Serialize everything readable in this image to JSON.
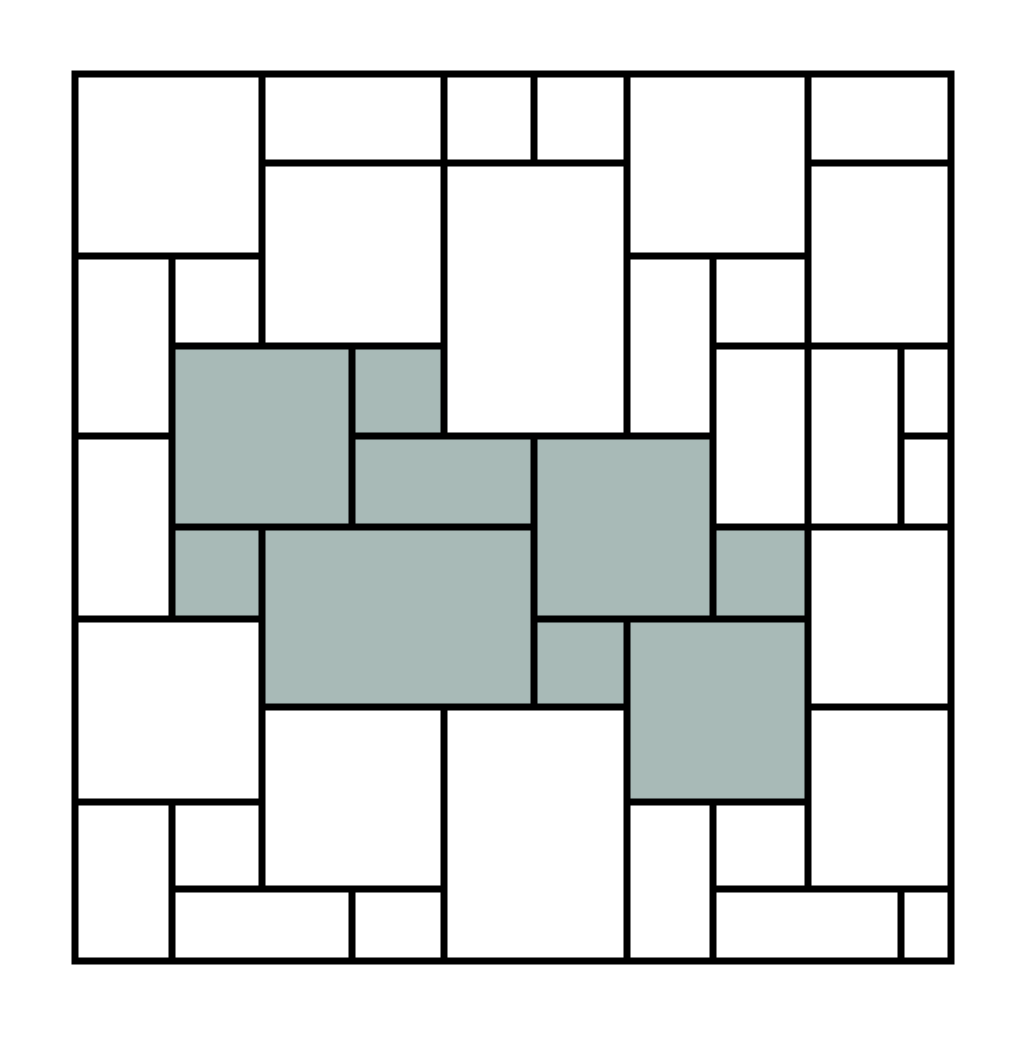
{
  "figure": {
    "canvas_width": 1024,
    "canvas_height": 1038,
    "background_color": "#ffffff",
    "stroke_color": "#000000",
    "stroke_width": 7,
    "tile_fill_white": "#ffffff",
    "tile_fill_shaded": "#a8bab7",
    "outer_square": {
      "x": 75,
      "y": 74,
      "width": 876,
      "height": 887
    },
    "grid_x": [
      75,
      172,
      262,
      352,
      444,
      534,
      627,
      713,
      808,
      901,
      951
    ],
    "grid_y": [
      74,
      163,
      256,
      346,
      436,
      527,
      619,
      707,
      802,
      889,
      961
    ],
    "tiles": [
      {
        "c1": 0,
        "r1": 0,
        "c2": 2,
        "r2": 2,
        "shaded": false
      },
      {
        "c1": 2,
        "r1": 0,
        "c2": 4,
        "r2": 1,
        "shaded": false
      },
      {
        "c1": 4,
        "r1": 0,
        "c2": 5,
        "r2": 1,
        "shaded": false
      },
      {
        "c1": 5,
        "r1": 0,
        "c2": 6,
        "r2": 1,
        "shaded": false
      },
      {
        "c1": 6,
        "r1": 0,
        "c2": 8,
        "r2": 2,
        "shaded": false
      },
      {
        "c1": 8,
        "r1": 0,
        "c2": 10,
        "r2": 1,
        "shaded": false
      },
      {
        "c1": 2,
        "r1": 1,
        "c2": 4,
        "r2": 3,
        "shaded": false
      },
      {
        "c1": 4,
        "r1": 1,
        "c2": 6,
        "r2": 4,
        "shaded": false
      },
      {
        "c1": 8,
        "r1": 1,
        "c2": 10,
        "r2": 3,
        "shaded": false
      },
      {
        "c1": 0,
        "r1": 2,
        "c2": 1,
        "r2": 4,
        "shaded": false
      },
      {
        "c1": 1,
        "r1": 2,
        "c2": 2,
        "r2": 3,
        "shaded": false
      },
      {
        "c1": 6,
        "r1": 2,
        "c2": 7,
        "r2": 4,
        "shaded": false
      },
      {
        "c1": 7,
        "r1": 2,
        "c2": 8,
        "r2": 3,
        "shaded": false
      },
      {
        "c1": 7,
        "r1": 3,
        "c2": 8,
        "r2": 5,
        "shaded": false
      },
      {
        "c1": 8,
        "r1": 3,
        "c2": 9,
        "r2": 5,
        "shaded": false
      },
      {
        "c1": 9,
        "r1": 3,
        "c2": 10,
        "r2": 4,
        "shaded": false
      },
      {
        "c1": 9,
        "r1": 4,
        "c2": 10,
        "r2": 5,
        "shaded": false
      },
      {
        "c1": 0,
        "r1": 4,
        "c2": 1,
        "r2": 6,
        "shaded": false
      },
      {
        "c1": 1,
        "r1": 3,
        "c2": 3,
        "r2": 5,
        "shaded": true
      },
      {
        "c1": 3,
        "r1": 3,
        "c2": 4,
        "r2": 4,
        "shaded": true
      },
      {
        "c1": 3,
        "r1": 4,
        "c2": 5,
        "r2": 5,
        "shaded": true
      },
      {
        "c1": 5,
        "r1": 4,
        "c2": 7,
        "r2": 6,
        "shaded": true
      },
      {
        "c1": 1,
        "r1": 5,
        "c2": 2,
        "r2": 6,
        "shaded": true
      },
      {
        "c1": 2,
        "r1": 5,
        "c2": 5,
        "r2": 7,
        "shaded": true
      },
      {
        "c1": 7,
        "r1": 5,
        "c2": 8,
        "r2": 6,
        "shaded": true
      },
      {
        "c1": 5,
        "r1": 6,
        "c2": 6,
        "r2": 7,
        "shaded": true
      },
      {
        "c1": 6,
        "r1": 6,
        "c2": 8,
        "r2": 8,
        "shaded": true
      },
      {
        "c1": 8,
        "r1": 5,
        "c2": 10,
        "r2": 7,
        "shaded": false
      },
      {
        "c1": 0,
        "r1": 6,
        "c2": 2,
        "r2": 8,
        "shaded": false
      },
      {
        "c1": 2,
        "r1": 7,
        "c2": 4,
        "r2": 9,
        "shaded": false
      },
      {
        "c1": 4,
        "r1": 7,
        "c2": 6,
        "r2": 10,
        "shaded": false
      },
      {
        "c1": 8,
        "r1": 7,
        "c2": 10,
        "r2": 9,
        "shaded": false
      },
      {
        "c1": 0,
        "r1": 8,
        "c2": 1,
        "r2": 10,
        "shaded": false
      },
      {
        "c1": 1,
        "r1": 8,
        "c2": 2,
        "r2": 9,
        "shaded": false
      },
      {
        "c1": 6,
        "r1": 8,
        "c2": 7,
        "r2": 10,
        "shaded": false
      },
      {
        "c1": 7,
        "r1": 8,
        "c2": 8,
        "r2": 9,
        "shaded": false
      },
      {
        "c1": 1,
        "r1": 9,
        "c2": 3,
        "r2": 10,
        "shaded": false
      },
      {
        "c1": 3,
        "r1": 9,
        "c2": 4,
        "r2": 10,
        "shaded": false
      },
      {
        "c1": 7,
        "r1": 9,
        "c2": 9,
        "r2": 10,
        "shaded": false
      },
      {
        "c1": 9,
        "r1": 9,
        "c2": 10,
        "r2": 10,
        "shaded": false
      }
    ]
  }
}
